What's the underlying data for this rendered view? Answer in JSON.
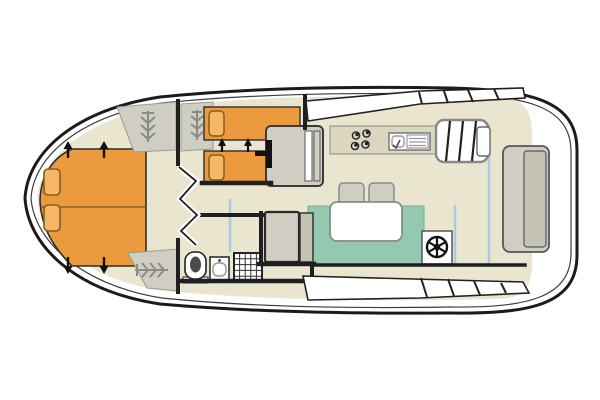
{
  "diagram": {
    "type": "boat-floor-plan",
    "subject": "Top-down deck plan of a canal cruising boat",
    "rooms": [
      {
        "name": "bow-cabin",
        "furniture": [
          "convertible-double-bed",
          "two-pillows",
          "wardrobe",
          "expansion-arrows"
        ]
      },
      {
        "name": "mid-cabin",
        "furniture": [
          "single-bed",
          "single-bed",
          "wardrobe",
          "cabinet-with-handle",
          "join-arrows"
        ]
      },
      {
        "name": "bathroom",
        "furniture": [
          "toilet",
          "washbasin",
          "shower-tray",
          "shower-screen",
          "folding-door"
        ]
      },
      {
        "name": "galley",
        "furniture": [
          "worktop",
          "four-burner-hob",
          "sink-with-drainer"
        ]
      },
      {
        "name": "saloon",
        "furniture": [
          "bench-seat",
          "dining-table",
          "stool",
          "stool",
          "sideboard",
          "helm-console",
          "steering-wheel"
        ]
      },
      {
        "name": "aft-deck",
        "furniture": [
          "companionway-steps",
          "stern-bench",
          "side-windows",
          "windscreen"
        ]
      }
    ]
  },
  "colors": {
    "hull": "#1b1b1b",
    "inner_line": "#3c3c3c",
    "floor": "#EAE5CE",
    "counter": "#DBD6C0",
    "counter_border": "#9a9a8e",
    "bed": "#EB9A3D",
    "bed_border": "#2e2e2e",
    "bed_divider": "#7a5a20",
    "pillow": "#F3B767",
    "pillow_border": "#8a5a1e",
    "bench": "#93C9B1",
    "bench_border": "#76b096",
    "furniture_gray": "#D0CEC3",
    "furniture_gray_dark": "#C4C2B4",
    "symbol_gray": "#8B8B85",
    "wall": "#1f1f1f",
    "glass": "#A9CBE4",
    "white": "#FFFFFF",
    "outline": "#222222",
    "mid_gray": "#8a8a8a",
    "steel": "#555555",
    "dark": "#111111",
    "toilet_seat": "#4a4a4a"
  }
}
